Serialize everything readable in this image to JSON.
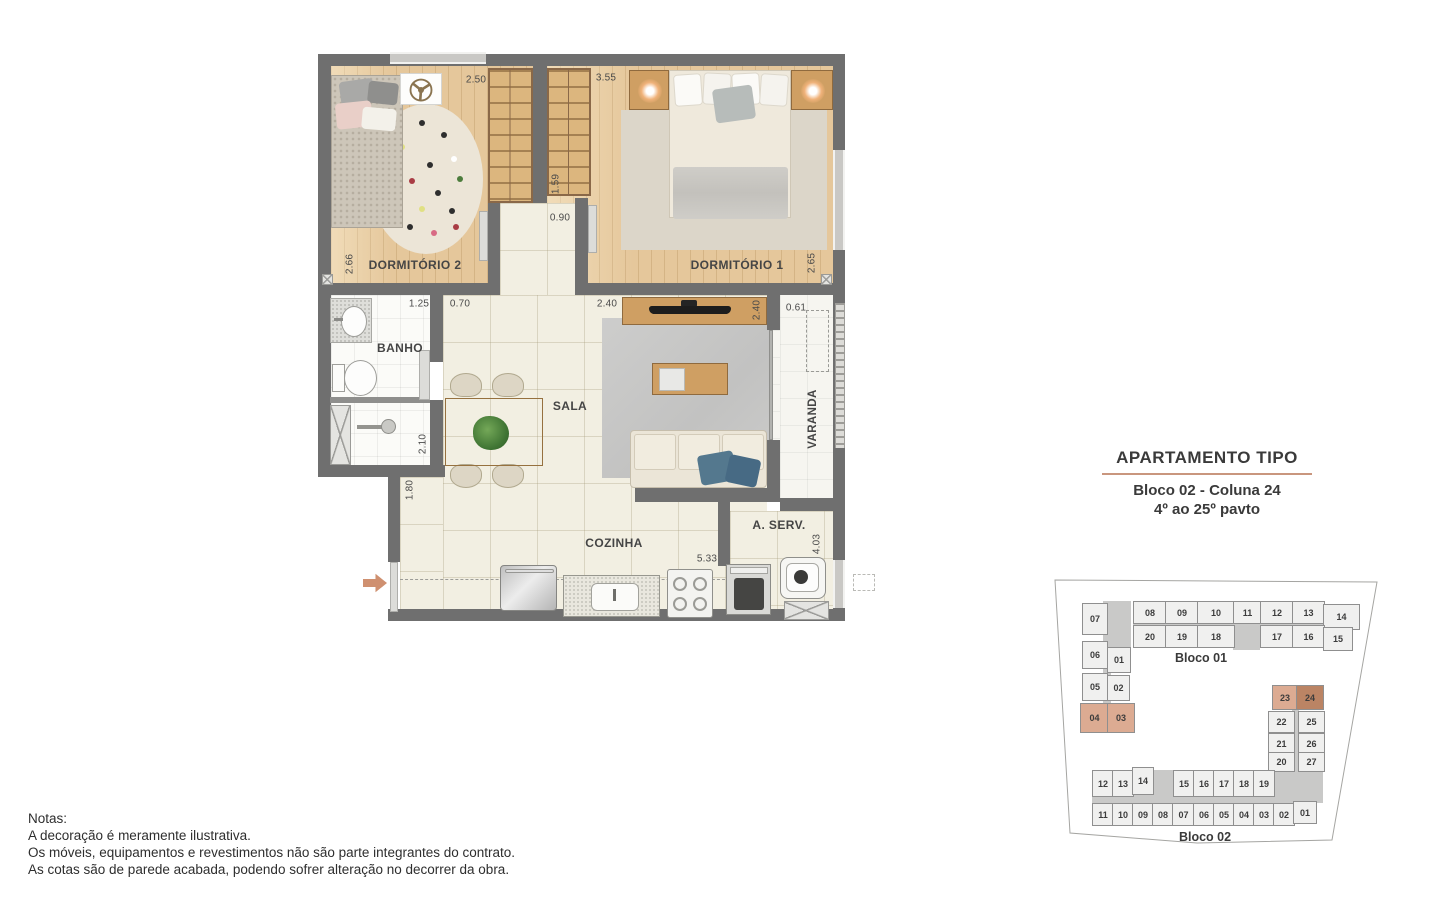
{
  "title_block": {
    "title": "APARTAMENTO TIPO",
    "subtitle1": "Bloco 02 - Coluna 24",
    "subtitle2": "4º ao 25º pavto"
  },
  "notes": {
    "heading": "Notas:",
    "lines": [
      "A decoração é meramente ilustrativa.",
      "Os móveis, equipamentos e revestimentos não são parte integrantes do contrato.",
      "As cotas são de parede acabada, podendo sofrer alteração no decorrer da obra."
    ]
  },
  "floor_plan": {
    "rooms": {
      "dormitorio2": "DORMITÓRIO 2",
      "dormitorio1": "DORMITÓRIO 1",
      "banho": "BANHO",
      "sala": "SALA",
      "cozinha": "COZINHA",
      "varanda": "VARANDA",
      "area_servico": "A. SERV."
    },
    "dimensions": {
      "dorm2_width": "2.50",
      "dorm1_width": "3.55",
      "wardrobe_depth": "1.59",
      "hall_width": "0.90",
      "dorm2_depth": "2.66",
      "dorm1_depth": "2.65",
      "banho_width": "1.25",
      "sala_offset": "0.70",
      "sala_width": "2.40",
      "sala_depth": "2.40",
      "varanda_width": "0.61",
      "banho_depth": "2.10",
      "cozinha_offset": "1.80",
      "cozinha_width": "5.33",
      "varanda_depth": "4.03"
    }
  },
  "keyplan": {
    "bloco01": {
      "label": "Bloco 01",
      "units": [
        {
          "n": "07",
          "x": 32,
          "y": 25,
          "w": 24,
          "h": 30
        },
        {
          "n": "06",
          "x": 32,
          "y": 63,
          "w": 24,
          "h": 26
        },
        {
          "n": "05",
          "x": 32,
          "y": 95,
          "w": 24,
          "h": 26
        },
        {
          "n": "04",
          "x": 30,
          "y": 125,
          "w": 27,
          "h": 28,
          "t": "hl"
        },
        {
          "n": "01",
          "x": 57,
          "y": 69,
          "w": 22,
          "h": 24
        },
        {
          "n": "02",
          "x": 57,
          "y": 97,
          "w": 21,
          "h": 24
        },
        {
          "n": "03",
          "x": 57,
          "y": 125,
          "w": 26,
          "h": 28,
          "t": "hl"
        },
        {
          "n": "08",
          "x": 83,
          "y": 23,
          "w": 32,
          "h": 21
        },
        {
          "n": "09",
          "x": 115,
          "y": 23,
          "w": 32,
          "h": 21
        },
        {
          "n": "10",
          "x": 147,
          "y": 23,
          "w": 36,
          "h": 21
        },
        {
          "n": "11",
          "x": 183,
          "y": 23,
          "w": 27,
          "h": 21
        },
        {
          "n": "12",
          "x": 210,
          "y": 23,
          "w": 32,
          "h": 21
        },
        {
          "n": "13",
          "x": 242,
          "y": 23,
          "w": 31,
          "h": 21
        },
        {
          "n": "14",
          "x": 273,
          "y": 26,
          "w": 35,
          "h": 24
        },
        {
          "n": "20",
          "x": 83,
          "y": 47,
          "w": 32,
          "h": 21
        },
        {
          "n": "19",
          "x": 115,
          "y": 47,
          "w": 32,
          "h": 21
        },
        {
          "n": "18",
          "x": 147,
          "y": 47,
          "w": 36,
          "h": 21
        },
        {
          "n": "17",
          "x": 210,
          "y": 47,
          "w": 32,
          "h": 21
        },
        {
          "n": "16",
          "x": 242,
          "y": 47,
          "w": 31,
          "h": 21
        },
        {
          "n": "15",
          "x": 273,
          "y": 49,
          "w": 28,
          "h": 22
        }
      ],
      "corridors": [
        {
          "x": 53,
          "y": 23,
          "w": 28,
          "h": 48
        },
        {
          "x": 53,
          "y": 71,
          "w": 8,
          "h": 60
        },
        {
          "x": 83,
          "y": 41,
          "w": 210,
          "h": 8
        },
        {
          "x": 183,
          "y": 44,
          "w": 27,
          "h": 28
        }
      ]
    },
    "bloco02": {
      "label": "Bloco 02",
      "units": [
        {
          "n": "23",
          "x": 222,
          "y": 107,
          "w": 24,
          "h": 23,
          "t": "hl"
        },
        {
          "n": "24",
          "x": 246,
          "y": 107,
          "w": 26,
          "h": 23,
          "t": "hd"
        },
        {
          "n": "22",
          "x": 218,
          "y": 133,
          "w": 25,
          "h": 20
        },
        {
          "n": "25",
          "x": 248,
          "y": 133,
          "w": 25,
          "h": 20
        },
        {
          "n": "21",
          "x": 218,
          "y": 155,
          "w": 25,
          "h": 19
        },
        {
          "n": "26",
          "x": 248,
          "y": 155,
          "w": 25,
          "h": 19
        },
        {
          "n": "20",
          "x": 218,
          "y": 174,
          "w": 25,
          "h": 18
        },
        {
          "n": "27",
          "x": 248,
          "y": 174,
          "w": 25,
          "h": 18
        },
        {
          "n": "12",
          "x": 42,
          "y": 192,
          "w": 20,
          "h": 25
        },
        {
          "n": "13",
          "x": 62,
          "y": 192,
          "w": 20,
          "h": 25
        },
        {
          "n": "14",
          "x": 82,
          "y": 189,
          "w": 20,
          "h": 26
        },
        {
          "n": "15",
          "x": 123,
          "y": 192,
          "w": 20,
          "h": 25
        },
        {
          "n": "16",
          "x": 143,
          "y": 192,
          "w": 20,
          "h": 25
        },
        {
          "n": "17",
          "x": 163,
          "y": 192,
          "w": 20,
          "h": 25
        },
        {
          "n": "18",
          "x": 183,
          "y": 192,
          "w": 20,
          "h": 25
        },
        {
          "n": "19",
          "x": 203,
          "y": 192,
          "w": 20,
          "h": 25
        },
        {
          "n": "11",
          "x": 42,
          "y": 225,
          "w": 20,
          "h": 21
        },
        {
          "n": "10",
          "x": 62,
          "y": 225,
          "w": 20,
          "h": 21
        },
        {
          "n": "09",
          "x": 82,
          "y": 225,
          "w": 20,
          "h": 21
        },
        {
          "n": "08",
          "x": 102,
          "y": 225,
          "w": 20,
          "h": 21
        },
        {
          "n": "07",
          "x": 122,
          "y": 225,
          "w": 21,
          "h": 21
        },
        {
          "n": "06",
          "x": 143,
          "y": 225,
          "w": 20,
          "h": 21
        },
        {
          "n": "05",
          "x": 163,
          "y": 225,
          "w": 20,
          "h": 21
        },
        {
          "n": "04",
          "x": 183,
          "y": 225,
          "w": 20,
          "h": 21
        },
        {
          "n": "03",
          "x": 203,
          "y": 225,
          "w": 20,
          "h": 21
        },
        {
          "n": "02",
          "x": 223,
          "y": 225,
          "w": 20,
          "h": 21
        },
        {
          "n": "01",
          "x": 243,
          "y": 223,
          "w": 22,
          "h": 21
        }
      ],
      "corridors": [
        {
          "x": 242,
          "y": 110,
          "w": 7,
          "h": 85
        },
        {
          "x": 220,
          "y": 192,
          "w": 53,
          "h": 30
        },
        {
          "x": 102,
          "y": 192,
          "w": 21,
          "h": 33
        },
        {
          "x": 42,
          "y": 217,
          "w": 231,
          "h": 8
        }
      ]
    }
  },
  "colors": {
    "wall_gray": "#6f6f6f",
    "accent_salmon": "#cf9070",
    "title_underline": "#c9967e",
    "keyplan_highlight_light": "#dcab92",
    "keyplan_highlight_dark": "#bb8464"
  }
}
